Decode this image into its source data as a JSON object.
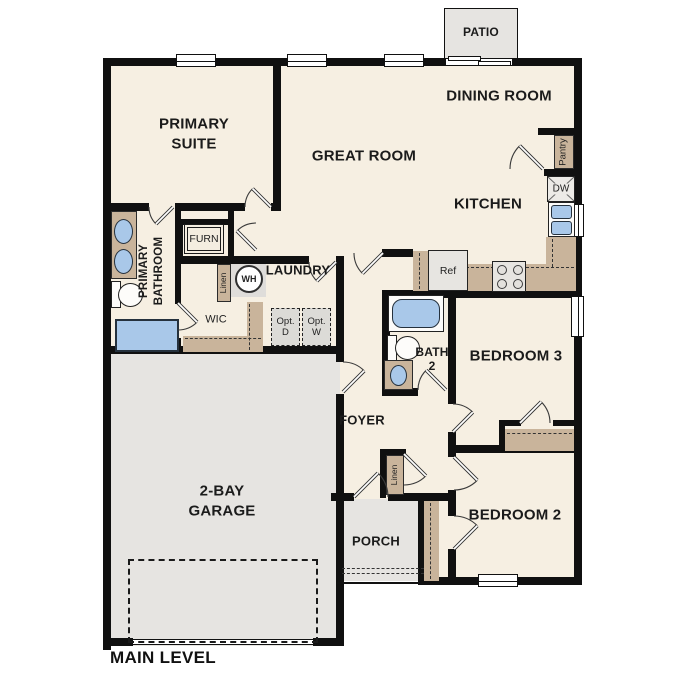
{
  "title": {
    "level": "MAIN LEVEL"
  },
  "rooms": {
    "patio": "PATIO",
    "dining_room": "DINING ROOM",
    "great_room": "GREAT ROOM",
    "primary_suite": "PRIMARY\nSUITE",
    "kitchen": "KITCHEN",
    "primary_bathroom": "PRIMARY\nBATHROOM",
    "laundry": "LAUNDRY",
    "wic": "WIC",
    "foyer": "FOYER",
    "bath_2": "BATH\n2",
    "bedroom_3": "BEDROOM 3",
    "bedroom_2": "BEDROOM 2",
    "porch": "PORCH",
    "garage": "2-BAY\nGARAGE"
  },
  "labels": {
    "furnace": "FURN",
    "water_heater": "WH",
    "linen_primary_hall": "Linen",
    "linen_bedroom_hall": "Linen",
    "pantry": "Pantry",
    "dishwasher": "DW",
    "refrigerator": "Ref",
    "optional_dryer": "Opt.\nD",
    "optional_washer": "Opt.\nW"
  },
  "colors": {
    "wall": "#101010",
    "room_fill": "#f6efe2",
    "hard_surface_fill": "#e6e4e1",
    "cabinet_tan": "#c9b49b",
    "fixture_blue": "#a9c8e9",
    "appliance_gray": "#e7e5e1"
  }
}
